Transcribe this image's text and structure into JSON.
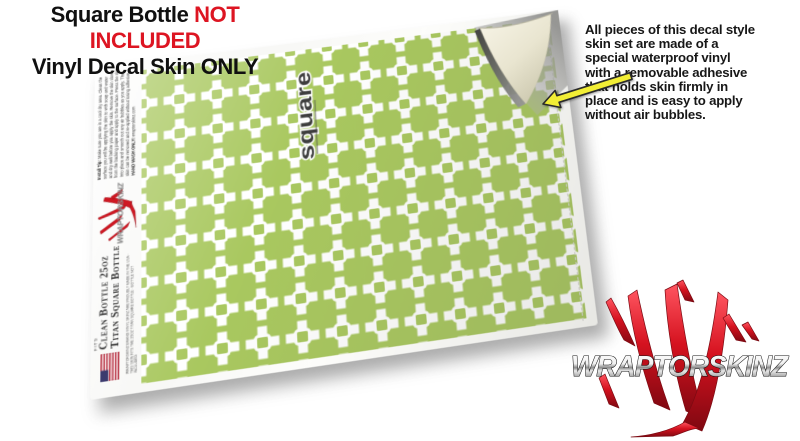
{
  "header": {
    "title_black": "Square Bottle ",
    "title_red": "NOT INCLUDED",
    "subtitle": "Vinyl Decal Skin ONLY"
  },
  "description": "All pieces of this decal style\nskin set are made of a\nspecial waterproof vinyl\nwith a removable adhesive\nthat holds skin firmly in\nplace and is easy to apply\nwithout air bubbles.",
  "sheet": {
    "install_tip_label": "Install Tip: ",
    "install_tip_body": "Make sure you are in a cool dry area. Clean the surface you will be applying the skin to with soap and water and dry well before you apply the skin. Remove the skin slowly from the backing paper and apply to the surface. Press the skin into place and smooth out any air bubbles as you apply. The skin can be removed and re-applied without losing adhesive. ",
    "hand_wash_label": "HAND WASH ONLY!",
    "site_label": " wraptorskinz.com",
    "fits_label": "FITS",
    "bottle_line1": "Clean Bottle 25oz",
    "bottle_line2": "Titan Square Bottle",
    "fine_print": "WRAPTORSKINZ BRAND VINYL SKINZ ARE PROUDLY MADE IN THE USA · THIS SKIN FITS THE 25OZ TITAN SQUARE BOTTLE · BOTTLE NOT INCLUDED",
    "square_logo_text": "square"
  },
  "brand": {
    "logo_text": "WRAPTORSKINZ"
  },
  "colors": {
    "pattern_green": "#a9c85f",
    "accent_red": "#dd1522",
    "claw_red": "#d5121f",
    "arrow_yellow": "#f2ee35",
    "backing_cream": "#efecd9"
  }
}
